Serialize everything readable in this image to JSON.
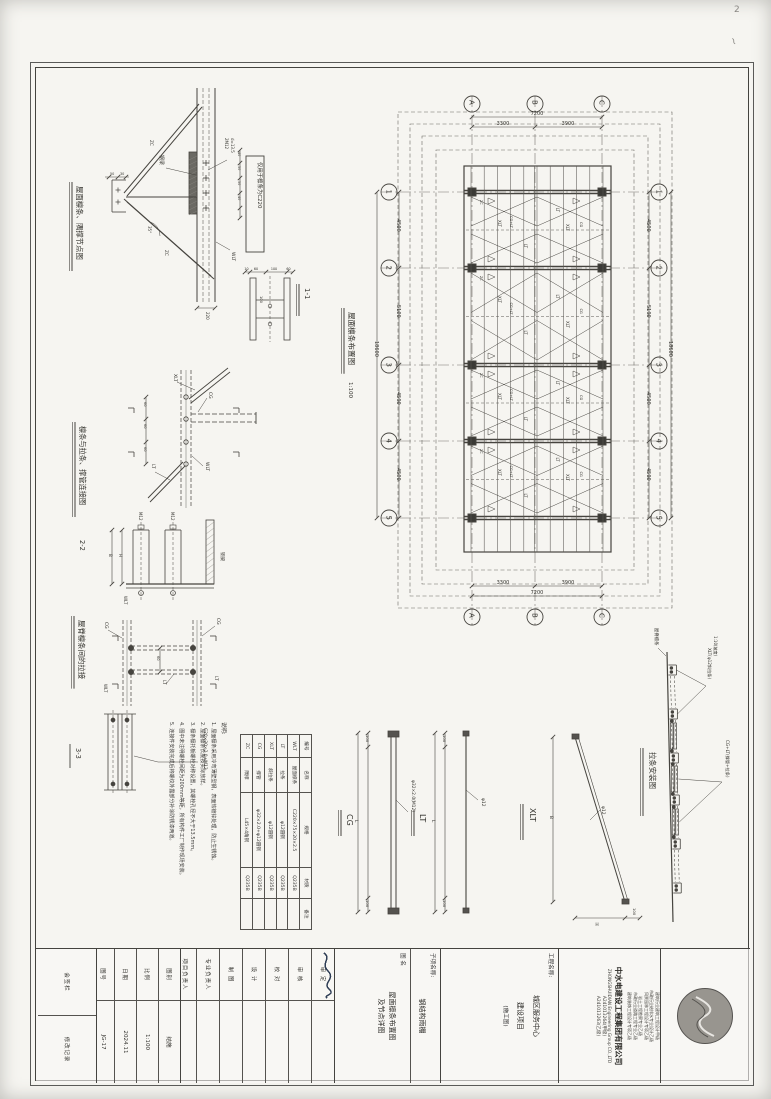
{
  "sheet": {
    "page_num": "2"
  },
  "plan": {
    "title": "屋面檩条布置图",
    "scale": "1:100",
    "grid_letters": [
      "A",
      "B",
      "C"
    ],
    "grid_numbers": [
      "1",
      "2",
      "3",
      "4",
      "5"
    ],
    "dims_top": {
      "total": "7200",
      "segs": [
        "3300",
        "3900"
      ]
    },
    "dims_side": {
      "segs": [
        "4500",
        "5100",
        "4500",
        "4500"
      ],
      "total": "18600"
    },
    "labels": {
      "xlt": "XLT",
      "lt": "LT",
      "cg": "CG",
      "cg_lt": "CG+LT",
      "wlt": "WLT",
      "zc": "ZC"
    }
  },
  "detail11": {
    "title": "屋面檩条、隅撑节点图",
    "mark": "1-1",
    "note_box": "仅用于檩条为C220",
    "labels": {
      "beam": "钢梁",
      "wlt": "WLT",
      "zc": "ZC",
      "bolt1": "2M12",
      "bolt2": "d=13.5",
      "angle": "35°"
    },
    "dims": {
      "depth": "220",
      "gauge": [
        "40",
        "50",
        "50",
        "40"
      ],
      "gusset": [
        "50",
        "30"
      ],
      "sec": [
        "10",
        "60",
        "100",
        "60"
      ],
      "h100": "100"
    }
  },
  "detail22": {
    "title": "檩条与拉条、撑管连接图",
    "mark": "2-2",
    "labels": {
      "xlt": "XLT",
      "cg": "CG",
      "wlt": "WLT",
      "lt": "LT",
      "m12": "M12",
      "beam": "钢梁"
    },
    "dims": {
      "s60": [
        "60",
        "60",
        "60"
      ],
      "H": "H",
      "B": "B"
    }
  },
  "detail33": {
    "title": "屋脊檩条间的拉接",
    "mark": "3-3",
    "labels": {
      "cg": "CG",
      "lt": "LT",
      "wlt": "WLT",
      "callout": "C20×20×2.0+M12"
    },
    "dims": {
      "s60": "60"
    }
  },
  "members": {
    "cg": {
      "name": "CG",
      "callout": "φ32×2.0(M12)",
      "dim_end": "100",
      "len": "L"
    },
    "lt": {
      "name": "LT",
      "callout": "φ12",
      "dim_end": "100",
      "len": "L"
    },
    "xlt": {
      "name": "XLT",
      "callout": "φ12",
      "dim_end": "100",
      "dim_b": "B",
      "dim_h": "H"
    }
  },
  "install": {
    "title": "拉条安装图",
    "ridge_label": "屋脊檩条",
    "slope": "1:10(坡度)",
    "callout_xlt": "XLT(φ12斜拉条)",
    "callout_cg": "CG+LT(撑管+拉条)"
  },
  "notes": {
    "heading": "说明:",
    "items": [
      "1. 屋面檩条采用冷弯薄壁型钢，表面热镀锌处理，防止生锈蚀。",
      "2. 屋面檩条长度按实际放样。",
      "3. 檩条檩托板螺栓对称设置，其螺栓孔径不大于13.5mm。",
      "4. 图中未注明螺栓间距为200mm等距，所有构件工厂制作现场安装。",
      "5. 连接件安装完成后将螺纹外露部分补涂防锈漆两道。"
    ]
  },
  "material_table": {
    "title": "材料表",
    "headers": [
      "编号",
      "名称",
      "规格",
      "材质",
      "备注"
    ],
    "rows": [
      [
        "WLT",
        "屋面檩条",
        "C220×75×20×2.5",
        "Q235B",
        ""
      ],
      [
        "LT",
        "拉条",
        "φ12圆钢",
        "Q235B",
        ""
      ],
      [
        "XLT",
        "斜拉条",
        "φ12圆钢",
        "Q235B",
        ""
      ],
      [
        "CG",
        "撑管",
        "φ32×2.0+φ12圆钢",
        "Q235B",
        ""
      ],
      [
        "ZC",
        "隅撑",
        "L45×4角钢",
        "Q235B",
        ""
      ]
    ]
  },
  "titleblock": {
    "quals": [
      "建筑行业建筑工程设计甲级",
      "市政行业给排水专业设计乙级",
      "风景园林工程设计专项乙级",
      "岩土工程勘察专业乙级",
      "市政行业道路工程专业乙级",
      "建筑装饰工程设计专项乙级"
    ],
    "company_cn": "中水电建设工程集团有限公司",
    "company_en": "ZHONGSHUIDIAN Engineering Group CO.,LTD",
    "cert1": "A241013264(甲级)",
    "cert2": "A241013263(乙级)",
    "project_label": "工程名称:",
    "project_line1": "城区服务中心",
    "project_line2": "建设项目",
    "stage": "(施工图)",
    "subitem_label": "子项名称:",
    "subitem": "钢结构雨棚",
    "drawing_label": "图 名",
    "drawing_line1": "屋面檩条布置图",
    "drawing_line2": "及节点详图",
    "sig_rows": [
      "审 定",
      "审 核",
      "校 对",
      "设 计",
      "制 图",
      "专业负责人",
      "项目负责人"
    ],
    "grid_rows": [
      [
        "图别",
        "结施"
      ],
      [
        "比例",
        "1:100"
      ],
      [
        "日期",
        "2024.11"
      ],
      [
        "图号",
        "JG-17"
      ]
    ],
    "huiqian": "会签栏",
    "xiugai": "修改记录"
  }
}
